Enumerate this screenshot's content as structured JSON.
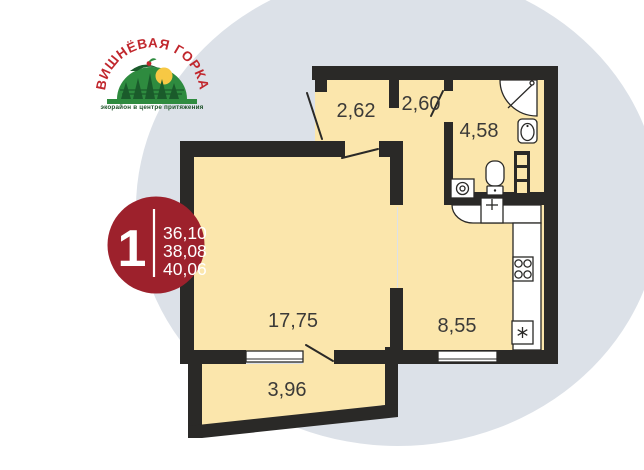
{
  "logo": {
    "arc_text": "ВИШНЁВАЯ ГОРКА",
    "tagline": "экорайон в центре притяжения"
  },
  "badge": {
    "rooms_count": "1",
    "areas": [
      "36,10",
      "38,08",
      "40,06"
    ]
  },
  "floorplan": {
    "rooms": [
      {
        "id": "entrance-hall",
        "area_label": "2,62"
      },
      {
        "id": "corridor",
        "area_label": "2,60"
      },
      {
        "id": "bathroom",
        "area_label": "4,58"
      },
      {
        "id": "living-room",
        "area_label": "17,75"
      },
      {
        "id": "kitchen",
        "area_label": "8,55"
      },
      {
        "id": "balcony",
        "area_label": "3,96"
      }
    ],
    "fixtures": [
      "shower",
      "washbasin",
      "toilet",
      "washing-machine",
      "towel-rail",
      "kitchen-sink",
      "stove",
      "fridge"
    ]
  },
  "colors": {
    "background": "#ffffff",
    "backdrop_blob": "#dce1e8",
    "walls": "#2a2927",
    "floor_fill": "#fbe6ac",
    "badge_red": "#9d212c",
    "logo_red": "#c1272d",
    "logo_green": "#2e8b3f",
    "logo_dark_green": "#1a5b2b",
    "sun_yellow": "#f7c844"
  }
}
